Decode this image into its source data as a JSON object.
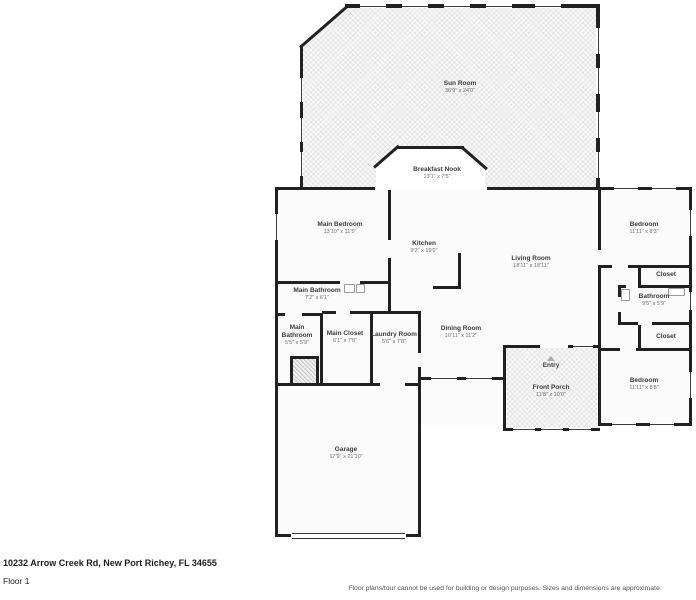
{
  "floorplan": {
    "rooms": [
      {
        "id": "sun-room",
        "name": "Sun Room",
        "dims": "36'9\" x 24'0\""
      },
      {
        "id": "breakfast-nook",
        "name": "Breakfast Nook",
        "dims": "13'1\" x 7'5\""
      },
      {
        "id": "main-bedroom",
        "name": "Main Bedroom",
        "dims": "13'10\" x 11'5\""
      },
      {
        "id": "kitchen",
        "name": "Kitchen",
        "dims": "9'2\" x 19'0\""
      },
      {
        "id": "living-room",
        "name": "Living Room",
        "dims": "18'11\" x 18'11\""
      },
      {
        "id": "bedroom-top-right",
        "name": "Bedroom",
        "dims": "11'11\" x 8'3\""
      },
      {
        "id": "closet-top-right",
        "name": "Closet",
        "dims": ""
      },
      {
        "id": "bathroom-right",
        "name": "Bathroom",
        "dims": "9'5\" x 5'9\""
      },
      {
        "id": "closet-bottom-right",
        "name": "Closet",
        "dims": ""
      },
      {
        "id": "bedroom-bottom-right",
        "name": "Bedroom",
        "dims": "11'11\" x 8'8\""
      },
      {
        "id": "main-bathroom",
        "name": "Main Bathroom",
        "dims": "7'2\" x 6'1\""
      },
      {
        "id": "main-bathroom-small",
        "name": "Main Bathroom",
        "dims": "5'5\" x 5'9\""
      },
      {
        "id": "main-closet",
        "name": "Main Closet",
        "dims": "6'1\" x 7'8\""
      },
      {
        "id": "laundry-room",
        "name": "Laundry Room",
        "dims": "5'6\" x 7'8\""
      },
      {
        "id": "dining-room",
        "name": "Dining Room",
        "dims": "10'11\" x 11'2\""
      },
      {
        "id": "entry",
        "name": "Entry",
        "dims": ""
      },
      {
        "id": "front-porch",
        "name": "Front Porch",
        "dims": "11'8\" x 10'0\""
      },
      {
        "id": "garage",
        "name": "Garage",
        "dims": "17'9\" x 21'10\""
      }
    ],
    "footer": {
      "address": "10232 Arrow Creek Rd, New Port Richey, FL 34655",
      "floor_label": "Floor 1",
      "disclaimer": "Floor plans/tour cannot be used for building or design purposes. Sizes and dimensions are approximate."
    },
    "colors": {
      "wall": "#212121",
      "room_fill": "#fbfbfb",
      "outdoor_hatch": "#f7f7f7",
      "text": "#3b3b3b"
    }
  }
}
